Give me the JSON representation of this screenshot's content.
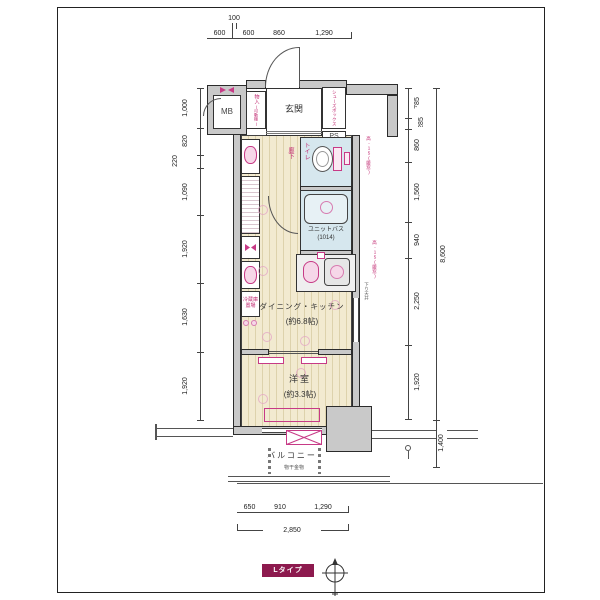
{
  "badge": {
    "label": "Lタイプ",
    "color": "#8d1a4e"
  },
  "labels": {
    "entrance": "玄関",
    "mb": "MB",
    "ps": "PS",
    "shoebox": "シューズボックス",
    "storage": "物入",
    "storage_note": "(可動棚)",
    "toilet": "トイレ",
    "bath": "ユニットバス",
    "bath_size": "(1014)",
    "hall": "廊下",
    "dk": "ダイニング・キッチン",
    "dk_size": "(約6.8帖)",
    "bedroom": "洋室",
    "bedroom_size": "(約3.3帖)",
    "balcony": "バルコニー",
    "laundry_hw": "物干金物",
    "fridge": "冷蔵庫置場",
    "window_note": "高-15(腰窓)",
    "beam_note": "下り天井"
  },
  "dims": {
    "top": [
      "600",
      "100",
      "600",
      "860",
      "1,290"
    ],
    "left": [
      "1,000",
      "820",
      "220",
      "1,090",
      "1,920",
      "1,630",
      "1,920"
    ],
    "right": [
      "785",
      "285",
      "860",
      "1,560",
      "940",
      "2,250",
      "1,920"
    ],
    "right_total": "8,600",
    "right_bottom": "1,400",
    "bottom": [
      "650",
      "910",
      "1,290"
    ],
    "bottom_total": "2,850"
  },
  "colors": {
    "accent_pink": "#c73a86",
    "badge": "#8d1a4e",
    "wall_gray": "#c9c9c9",
    "wood_floor": "#f2ead0",
    "wet_floor": "#d6e7ee"
  }
}
